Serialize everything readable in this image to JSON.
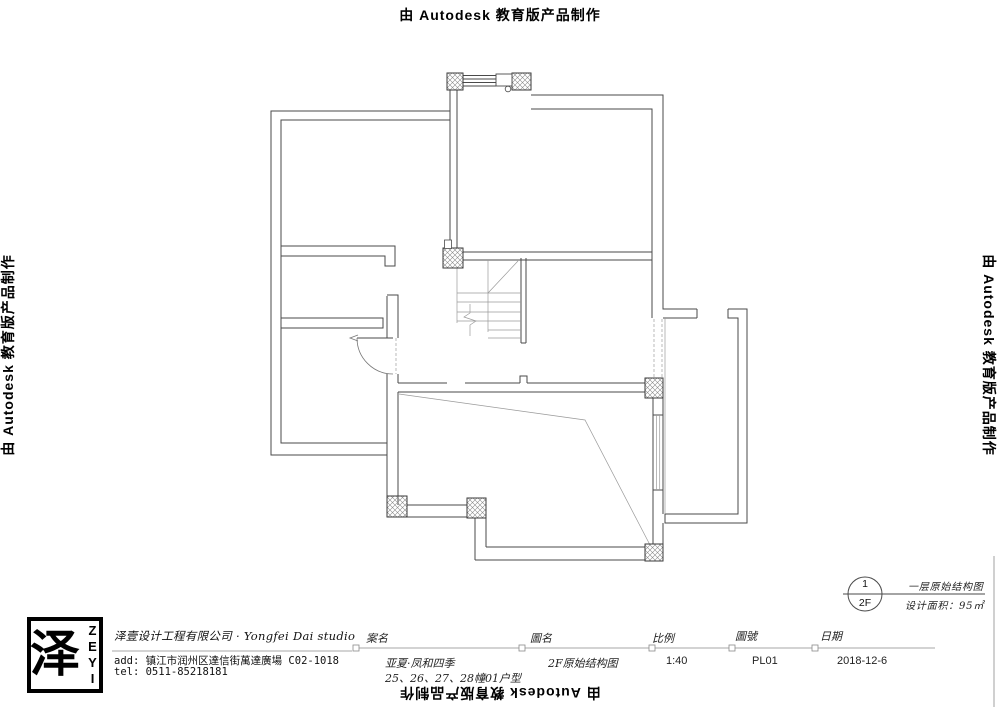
{
  "stamp": {
    "text": "由 Autodesk 教育版产品制作"
  },
  "annotation": {
    "circle_top": "1",
    "circle_bottom": "2F",
    "title": "一层原始结构图",
    "area": "设计面积：95㎡"
  },
  "title_block": {
    "logo_glyph": "泽",
    "logo_word": "ZEYI",
    "company": "泽壹设计工程有限公司 · Yongfei Dai studio",
    "address": "add: 镇江市润州区達信街萬達廣場 C02-1018",
    "tel": "tel: 0511-85218181",
    "fields": [
      {
        "label": "案名",
        "value": "亚夏·凤和四季",
        "value2": "25、26、27、28幢01户型"
      },
      {
        "label": "圖名",
        "value": "2F原始结构图"
      },
      {
        "label": "比例",
        "value": "1:40"
      },
      {
        "label": "圖號",
        "value": "PL01"
      },
      {
        "label": "日期",
        "value": "2018-12-6"
      }
    ]
  }
}
